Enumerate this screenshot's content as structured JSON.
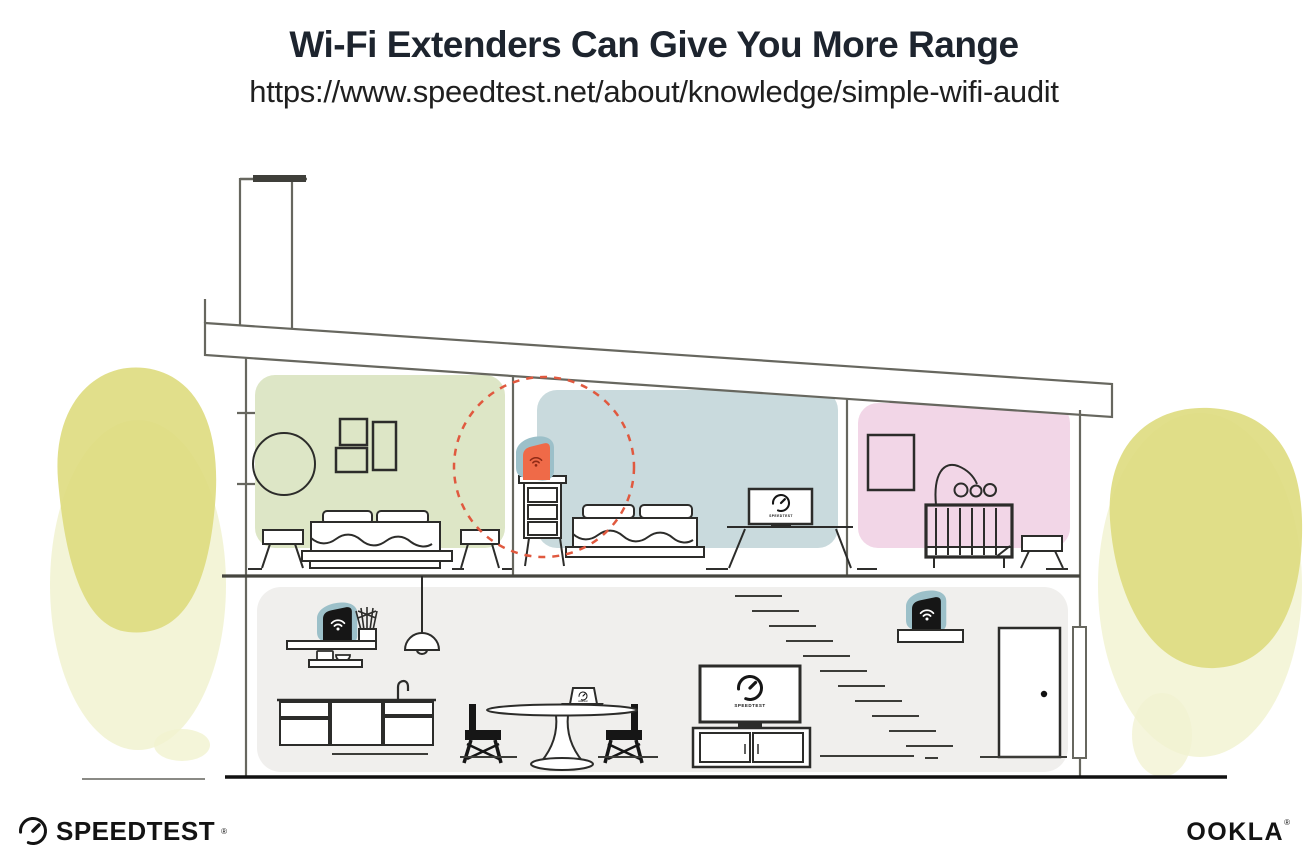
{
  "header": {
    "title": "Wi-Fi Extenders Can Give You More Range",
    "url": "https://www.speedtest.net/about/knowledge/simple-wifi-audit"
  },
  "screens": {
    "brand": "SPEEDTEST"
  },
  "footer": {
    "speedtest": {
      "label": "SPEEDTEST",
      "registered": "®"
    },
    "ookla": {
      "label": "OOKLA",
      "registered": "®"
    }
  },
  "colors": {
    "ink": "#1d242e",
    "structure_gray": "#67675f",
    "room_green": "#dde6c6",
    "room_blue": "#c9dadd",
    "room_pink": "#f2d6e7",
    "lower_floor_gray": "#f0efed",
    "device_teal": "#9cc0c9",
    "extender_orange": "#ef6a48",
    "extender_wifi_red": "#8f2a16",
    "router_black": "#161616",
    "range_dash_red": "#e0593f",
    "foliage_yellow": "#dedc7e",
    "foliage_wash": "#f1f2d0"
  },
  "icons": [
    "wifi-icon",
    "speedtest-gauge-icon"
  ]
}
